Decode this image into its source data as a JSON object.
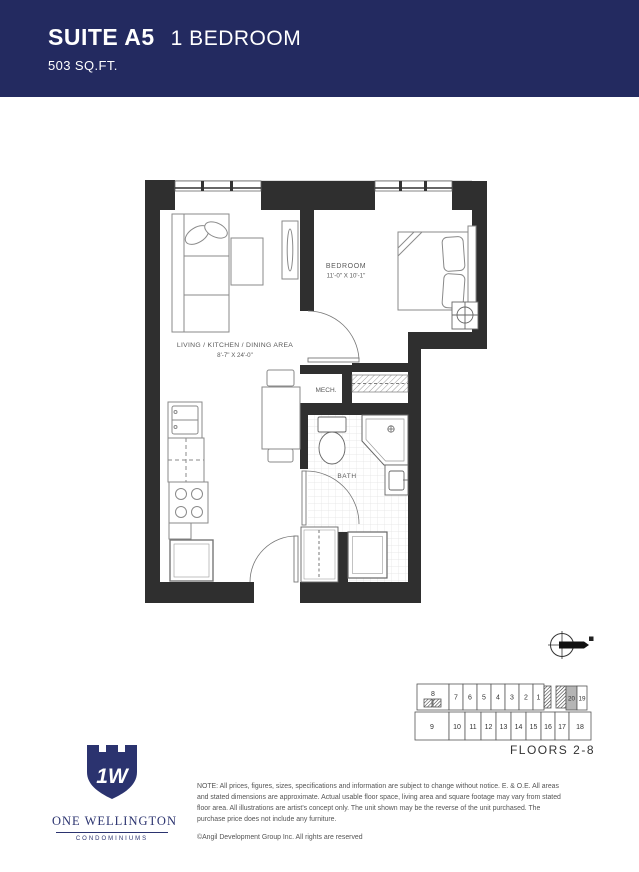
{
  "header": {
    "suite_label": "SUITE A5",
    "type_label": "1 BEDROOM",
    "area_label": "503 SQ.FT.",
    "bg_color": "#232a60",
    "text_color": "#ffffff"
  },
  "floorplan": {
    "wall_color": "#2f2f2f",
    "rooms": {
      "bedroom": {
        "name": "BEDROOM",
        "dims": "11'-0\" X 10'-1\""
      },
      "living": {
        "name": "LIVING / KITCHEN / DINING AREA",
        "dims": "8'-7\" X 24'-0\""
      },
      "mech": {
        "name": "MECH."
      },
      "bath": {
        "name": "BATH"
      }
    }
  },
  "keyplan": {
    "floors_label": "FLOORS 2-8",
    "highlighted_unit": "20",
    "highlight_color": "#b5b5b5",
    "top_row": [
      "8",
      "7",
      "6",
      "5",
      "4",
      "3",
      "2",
      "1",
      "20",
      "19"
    ],
    "bottom_row": [
      "9",
      "10",
      "11",
      "12",
      "13",
      "14",
      "15",
      "16",
      "17",
      "18"
    ]
  },
  "logo": {
    "monogram": "1W",
    "name": "ONE WELLINGTON",
    "subtitle": "CONDOMINIUMS",
    "color": "#2b336f"
  },
  "disclaimer": {
    "note": "NOTE: All prices, figures, sizes, specifications and information are subject to change without notice. E. & O.E. All areas and stated dimensions are approximate. Actual usable floor space, living area and square footage may vary from stated floor area. All illustrations are artist's concept only. The unit shown may be the reverse of the unit purchased. The purchase price does not include any furniture.",
    "copyright": "©Angil Development Group Inc. All rights are reserved"
  }
}
